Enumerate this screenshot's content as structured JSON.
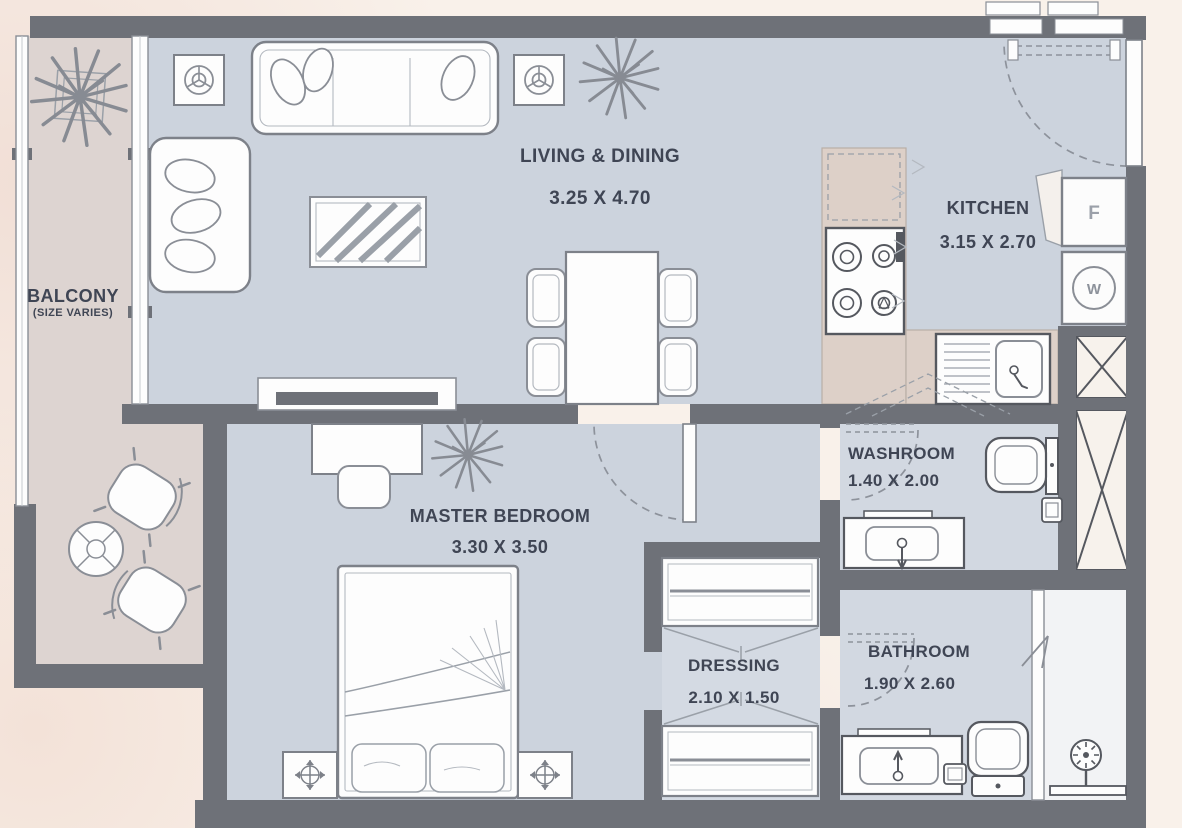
{
  "rooms": {
    "living": {
      "name": "LIVING & DINING",
      "dims": "3.25 X 4.70"
    },
    "kitchen": {
      "name": "KITCHEN",
      "dims": "3.15 X 2.70"
    },
    "balcony": {
      "name": "BALCONY",
      "note": "(SIZE VARIES)"
    },
    "master": {
      "name": "MASTER BEDROOM",
      "dims": "3.30 X 3.50"
    },
    "washroom": {
      "name": "WASHROOM",
      "dims": "1.40 X 2.00"
    },
    "dressing": {
      "name": "DRESSING",
      "dims": "2.10 X 1.50"
    },
    "bathroom": {
      "name": "BATHROOM",
      "dims": "1.90 X 2.60"
    }
  },
  "appliances": {
    "fridge": "F",
    "washer": "W"
  },
  "colors": {
    "wall": "#6e7178",
    "floor_main": "#ccd3dd",
    "floor_wet": "#d2d8e1",
    "floor_balcony": "#ddd4d1",
    "counter": "#ddd0c8",
    "background": "#f9f1ea",
    "furniture_outline": "#8a8e96",
    "text": "#3f4554",
    "shaft_fill": "#f7f2ec"
  }
}
